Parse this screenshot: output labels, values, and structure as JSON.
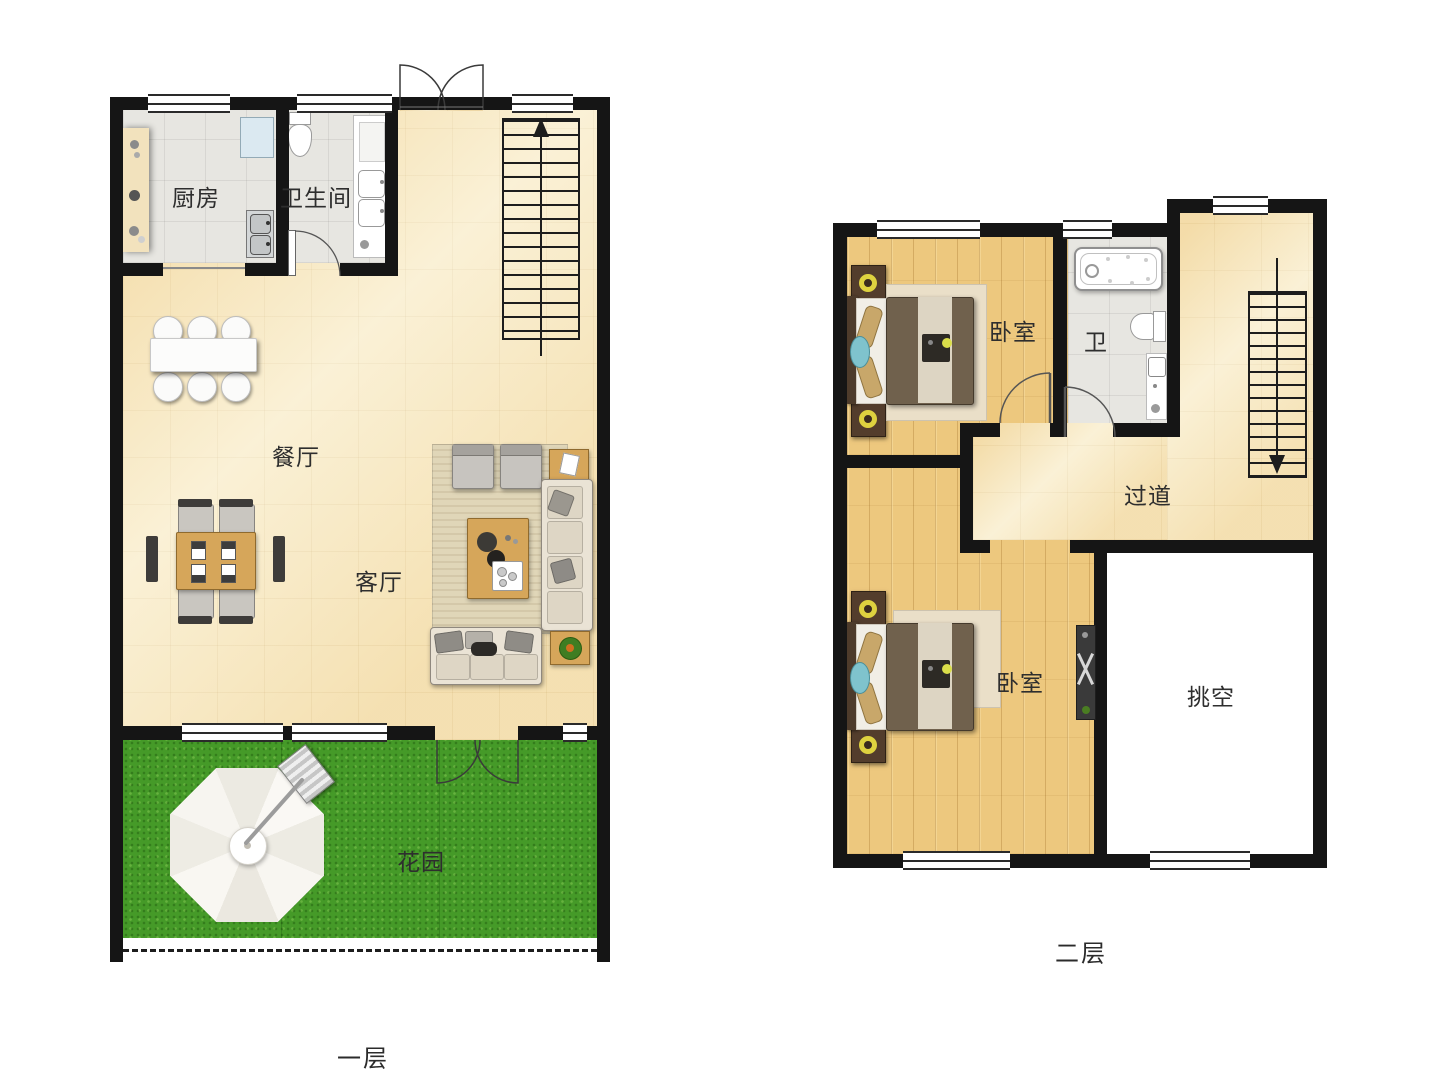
{
  "document": {
    "type": "residential floor plan, two levels"
  },
  "floor1": {
    "caption": "一层",
    "rooms": {
      "kitchen": "厨房",
      "bathroom": "卫生间",
      "dining": "餐厅",
      "living": "客厅",
      "garden": "花园"
    }
  },
  "floor2": {
    "caption": "二层",
    "rooms": {
      "bedroom_top": "卧室",
      "bathroom": "卫",
      "hallway": "过道",
      "bedroom_bottom": "卧室",
      "void": "挑空"
    }
  },
  "colors": {
    "wall": "#151515",
    "tile_cream": "#f7eac6",
    "tile_grey": "#e7e6e1",
    "wood_floor": "#edc87e",
    "grass_green": "#459a28",
    "furniture_wood": "#d6a65a",
    "sofa_cream": "#eae3d5",
    "void_white": "#ffffff",
    "lamp_yellow": "#ded23f",
    "pool_teal": "#7fc3cd"
  }
}
